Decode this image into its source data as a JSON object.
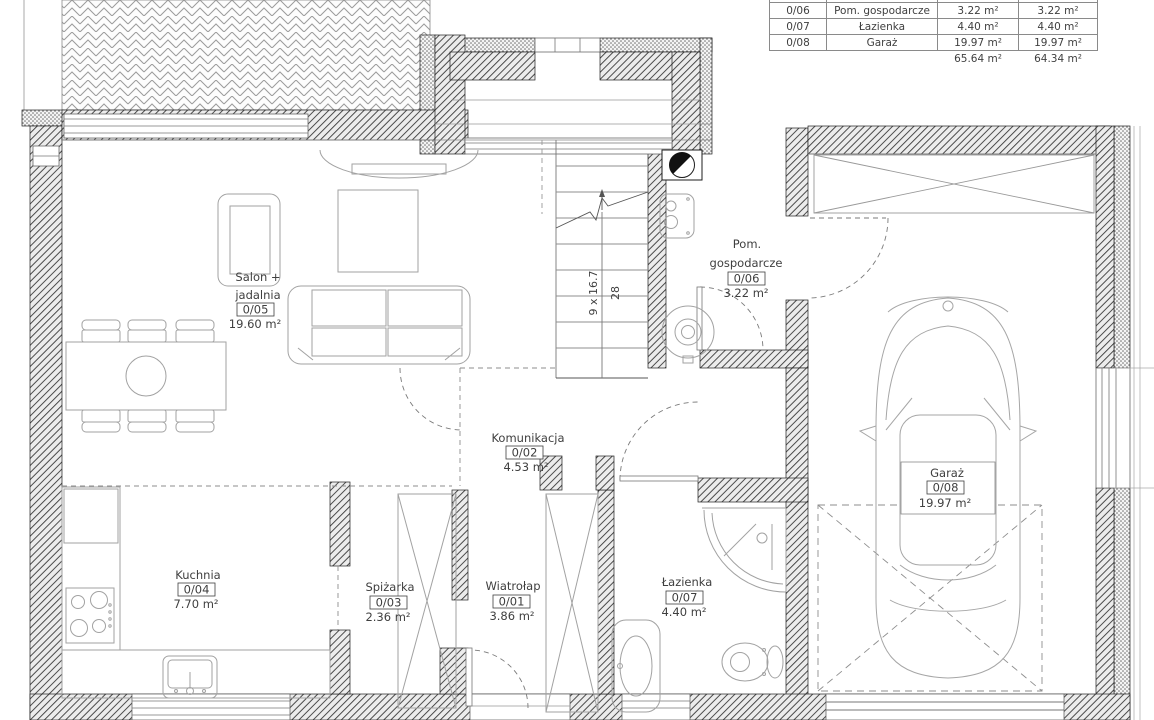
{
  "area_table": {
    "rows": [
      {
        "id": "0/06",
        "name": "Pom. gospodarcze",
        "area_design": "3.22 m²",
        "area_actual": "3.22 m²"
      },
      {
        "id": "0/07",
        "name": "Łazienka",
        "area_design": "4.40 m²",
        "area_actual": "4.40 m²"
      },
      {
        "id": "0/08",
        "name": "Garaż",
        "area_design": "19.97 m²",
        "area_actual": "19.97 m²"
      }
    ],
    "total_design": "65.64 m²",
    "total_actual": "64.34 m²"
  },
  "rooms": {
    "wiatrolap": {
      "name": "Wiatrołap",
      "id": "0/01",
      "area": "3.86 m²"
    },
    "komunikacja": {
      "name": "Komunikacja",
      "id": "0/02",
      "area": "4.53 m²"
    },
    "spizarka": {
      "name": "Spiżarka",
      "id": "0/03",
      "area": "2.36 m²"
    },
    "kuchnia": {
      "name": "Kuchnia",
      "id": "0/04",
      "area": "7.70 m²"
    },
    "salon": {
      "name_line1": "Salon +",
      "name_line2": "jadalnia",
      "id": "0/05",
      "area": "19.60 m²"
    },
    "pom_gospodarcze": {
      "name_line1": "Pom.",
      "name_line2": "gospodarcze",
      "id": "0/06",
      "area": "3.22 m²"
    },
    "lazienka": {
      "name": "Łazienka",
      "id": "0/07",
      "area": "4.40 m²"
    },
    "garaz": {
      "name": "Garaż",
      "id": "0/08",
      "area": "19.97 m²"
    }
  },
  "stairs": {
    "dimension": "9 x 16.7",
    "count": "28"
  }
}
